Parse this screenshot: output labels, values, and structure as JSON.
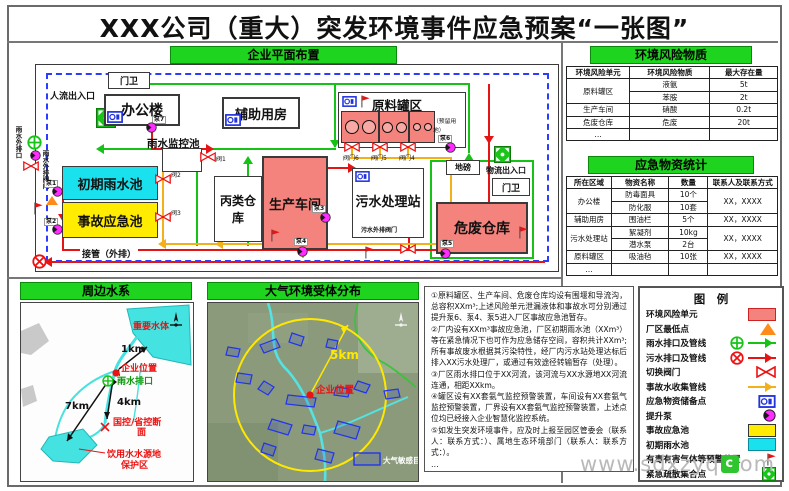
{
  "title": "XXX公司（重大）突发环境事件应急预案“一张图”",
  "colors": {
    "header_green": "#1ed41e",
    "risk_unit_pink": "#f4837d",
    "initial_rain_cyan": "#19e2ee",
    "accident_pool_yellow": "#ffec00",
    "pump_magenta": "#ff2bff",
    "rain_line_green": "#15c215",
    "sewage_line_red": "#e61515",
    "accident_line_orange": "#f2b01c",
    "boundary_blue": "#2b3cff"
  },
  "plan": {
    "header": "企业平面布置",
    "labels": {
      "gate_top": "门卫",
      "people_entrance": "人流出入口",
      "office": "办公楼",
      "aux_building": "辅助用房",
      "tank_area": "原料罐区",
      "reserved": "（预留用地）",
      "rain_monitor_pool": "雨水监控池",
      "initial_rain_pool": "初期雨水池",
      "accident_pool": "事故应急池",
      "class_c_warehouse": "丙类仓库",
      "workshop": "生产车间",
      "sewage_station": "污水处理站",
      "hazwaste_warehouse": "危废仓库",
      "weighbridge": "地磅",
      "logistics_entrance": "物流出入口",
      "gate_right": "门卫",
      "outfall_pipe": "接管（外排）",
      "sewage_out_valve": "污水外排阀门",
      "rain_outfall": "雨水外排口",
      "rain_out_valve": "雨水外排阀门",
      "valve6": "阀门6",
      "valve5": "阀门5",
      "valve4": "阀门4",
      "valve1": "阀1",
      "valve2": "阀2",
      "valve3": "阀3",
      "pump1": "泵1",
      "pump2": "泵2",
      "pump3": "泵3",
      "pump4": "泵4",
      "pump5": "泵5",
      "pump6": "泵6",
      "pump7": "泵7"
    }
  },
  "risk": {
    "header": "环境风险物质",
    "columns": [
      "环境风险单元",
      "环境风险物质",
      "最大存在量"
    ],
    "rows": [
      {
        "unit": "原料罐区",
        "substance": "液氨",
        "amount": "5t"
      },
      {
        "substance": "苯胺",
        "amount": "2t"
      },
      {
        "unit": "生产车间",
        "substance": "硝酸",
        "amount": "0.2t"
      },
      {
        "unit": "危废仓库",
        "substance": "危废",
        "amount": "20t"
      },
      {
        "unit": "…",
        "substance": "",
        "amount": ""
      }
    ]
  },
  "supplies": {
    "header": "应急物资统计",
    "columns": [
      "所在区域",
      "物资名称",
      "数量",
      "联系人及联系方式"
    ],
    "rows": [
      {
        "area": "办公楼",
        "item": "防毒面具",
        "qty": "10个",
        "contact": "XX，XXXX"
      },
      {
        "item": "防化服",
        "qty": "10套"
      },
      {
        "area": "辅助用房",
        "item": "围油栏",
        "qty": "5个",
        "contact": "XX，XXXX"
      },
      {
        "area": "污水处理站",
        "item": "絮凝剂",
        "qty": "10kg",
        "contact": "XX，XXXX"
      },
      {
        "item": "潜水泵",
        "qty": "2台"
      },
      {
        "area": "原料罐区",
        "item": "吸油毡",
        "qty": "10张",
        "contact": "XX，XXXX"
      },
      {
        "area": "…",
        "item": "",
        "qty": "",
        "contact": ""
      }
    ]
  },
  "legend": {
    "header": "图　例",
    "items": [
      {
        "label": "环境风险单元"
      },
      {
        "label": "厂区最低点"
      },
      {
        "label": "雨水排口及管线"
      },
      {
        "label": "污水排口及管线"
      },
      {
        "label": "切换阀门"
      },
      {
        "label": "事故水收集管线"
      },
      {
        "label": "应急物资储备点"
      },
      {
        "label": "提升泵"
      },
      {
        "label": "事故应急池"
      },
      {
        "label": "初期雨水池"
      },
      {
        "label": "有毒有害气体等预警装置"
      },
      {
        "label": "紧急疏散集合点"
      }
    ]
  },
  "water": {
    "header": "周边水系",
    "labels": {
      "important_water": "重要水体",
      "company": "企业位置",
      "rain_outlet": "雨水排口",
      "control_section_1": "国控/省控断",
      "control_section_2": "面",
      "drinking_1": "饮用水水源地",
      "drinking_2": "保护区",
      "d1": "1km",
      "d4": "4km",
      "d7": "7km"
    }
  },
  "air": {
    "header": "大气环境受体分布",
    "labels": {
      "radius": "5km",
      "company": "企业位置",
      "legend": "大气敏感目标"
    }
  },
  "notes": {
    "items": [
      "①原料罐区、生产车间、危废仓库均设有围堰和导流沟，总容积XXm³;上述风险单元泄漏液体和事故水可分别通过提升泵6、泵4、泵5进入厂区事故应急池暂存。",
      "②厂内设有XXm³事故应急池，厂区初期雨水池（XXm³）等在紧急情况下也可作为应急储存空间，容积共计XXm³;所有事故废水根据其污染特性，经厂内污水站处理达标后排入XX污水处理厂，或通过有效途径转输暂存（处理）。",
      "③厂区雨水排口位于XX河流，该河流与XX水源地XX河流连通，相距XXkm。",
      "④罐区设有XX套氨气监控预警装置，车间设有XX套氨气监控预警装置，厂界设有XX套氨气监控预警装置，上述点位均已经接入企业智慧化监控系统。",
      "⑤如发生突发环境事件，应及时上报至园区管委会（联系人：联系方式：）、属地生态环境部门（联系人：联系方式：）。",
      "…"
    ]
  },
  "watermark": {
    "prefix": "www.sdxzyq",
    "icon": "c",
    "suffix": "om"
  }
}
